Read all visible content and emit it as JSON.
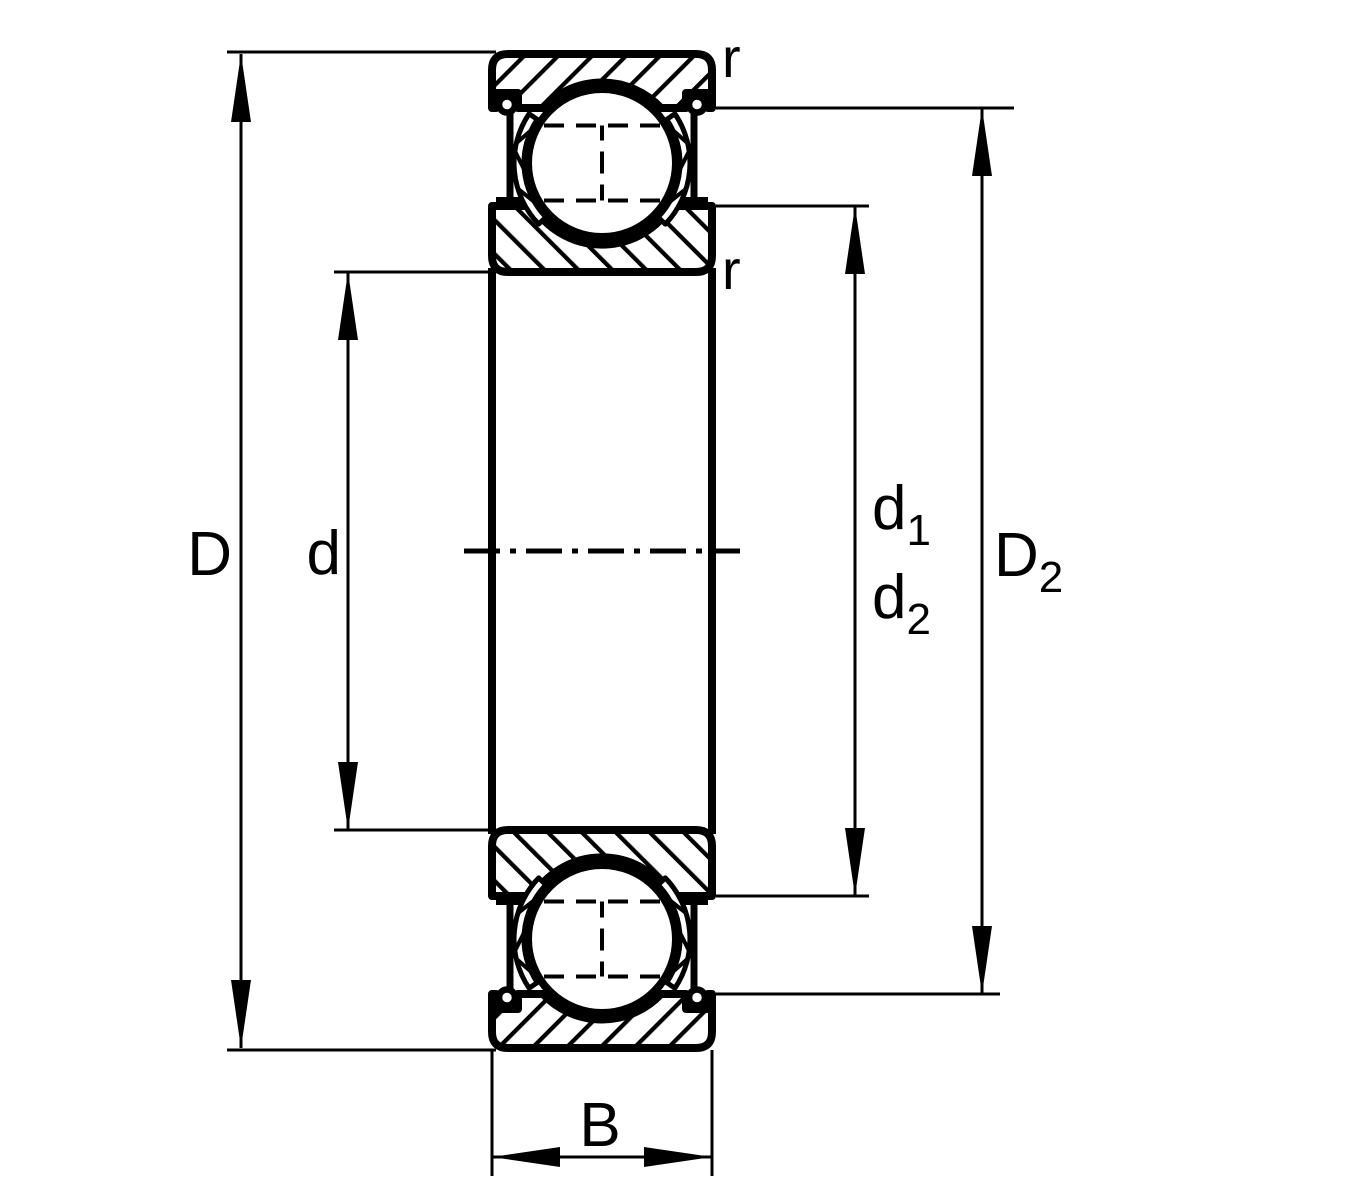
{
  "drawing": {
    "colors": {
      "line": "#000000",
      "background": "#ffffff"
    },
    "labels": {
      "D": {
        "base": "D",
        "sub": ""
      },
      "d": {
        "base": "d",
        "sub": ""
      },
      "d1": {
        "base": "d",
        "sub": "1"
      },
      "d2": {
        "base": "d",
        "sub": "2"
      },
      "D2": {
        "base": "D",
        "sub": "2"
      },
      "B": {
        "base": "B",
        "sub": ""
      },
      "r_outer_ring": "r",
      "r_inner_ring": "r"
    }
  }
}
